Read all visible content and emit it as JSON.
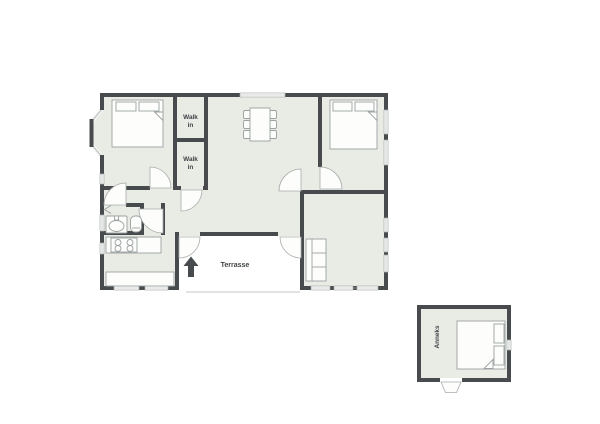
{
  "plan": {
    "type": "residential-floor-plan",
    "language": "Danish",
    "labels": {
      "walk_in_closet_1": {
        "line1": "Walk",
        "line2": "in"
      },
      "walk_in_closet_2": {
        "line1": "Walk",
        "line2": "in"
      },
      "terrace": "Terrasse",
      "annex": "Anneks"
    },
    "rooms_visible": [
      "bedroom-top-left",
      "walk-in-closet-1",
      "walk-in-closet-2",
      "living-dining-room",
      "bedroom-top-right",
      "bathroom",
      "kitchen",
      "terrace",
      "garden-room",
      "annex"
    ],
    "furniture_icons": [
      "double-bed-icon",
      "double-bed-icon",
      "double-bed-icon",
      "dining-table-six-chairs-icon",
      "sofa-icon",
      "sink-icon",
      "toilet-icon",
      "stove-icon",
      "counter-icon"
    ],
    "markers": {
      "north_arrow": "north-arrow-icon"
    },
    "colors": {
      "wall": "#474b4e",
      "floor": "#e9ebe5",
      "background": "#ffffff",
      "furniture_stroke": "#9ba1a1",
      "furniture_fill": "#fdfdfc",
      "window_frame": "#a9aeac",
      "door_arc": "#a8adab",
      "thin_line": "#c3c7c5",
      "text": "#3e4245"
    }
  }
}
